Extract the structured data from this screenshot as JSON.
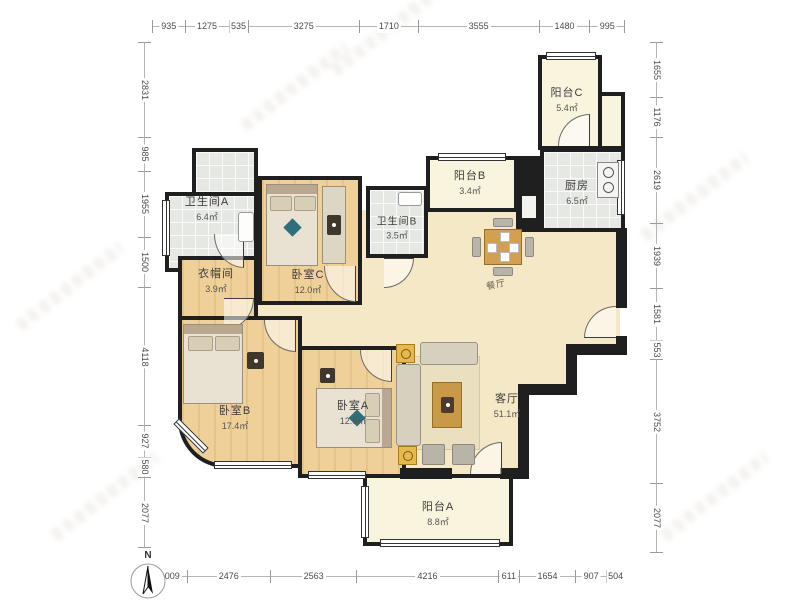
{
  "plan": {
    "rooms": {
      "bathroom_a": {
        "name": "卫生间A",
        "area": "6.4㎡"
      },
      "closet": {
        "name": "衣帽间",
        "area": "3.9㎡"
      },
      "bedroom_c": {
        "name": "卧室C",
        "area": "12.0㎡"
      },
      "bathroom_b": {
        "name": "卫生间B",
        "area": "3.5㎡"
      },
      "balcony_b": {
        "name": "阳台B",
        "area": "3.4㎡"
      },
      "kitchen": {
        "name": "厨房",
        "area": "6.5㎡"
      },
      "balcony_c": {
        "name": "阳台C",
        "area": "5.4㎡"
      },
      "dining": {
        "name": "餐厅",
        "area": ""
      },
      "bedroom_b": {
        "name": "卧室B",
        "area": "17.4㎡"
      },
      "bedroom_a": {
        "name": "卧室A",
        "area": "12.6㎡"
      },
      "living": {
        "name": "客厅",
        "area": "51.1㎡"
      },
      "balcony_a": {
        "name": "阳台A",
        "area": "8.8㎡"
      }
    },
    "compass": {
      "label": "N"
    }
  },
  "dimensions": {
    "top": [
      935,
      1275,
      535,
      3275,
      1710,
      3555,
      1480,
      995
    ],
    "bottom": [
      1009,
      2476,
      2563,
      4216,
      611,
      1654,
      907,
      504
    ],
    "left": [
      2831,
      985,
      1955,
      1500,
      4118,
      927,
      580,
      2077
    ],
    "right": [
      1655,
      1176,
      2619,
      1939,
      1581,
      553,
      3752,
      2077
    ]
  },
  "colors": {
    "wall": "#1f1f1f",
    "wood_floor": "#efd099",
    "tile_floor": "#e6e8e4",
    "balcony_floor": "#f8f4dd",
    "hall_floor": "#f4e8c6",
    "furniture_accent": "#d2a050",
    "dimension_text": "#4a4a4a"
  }
}
